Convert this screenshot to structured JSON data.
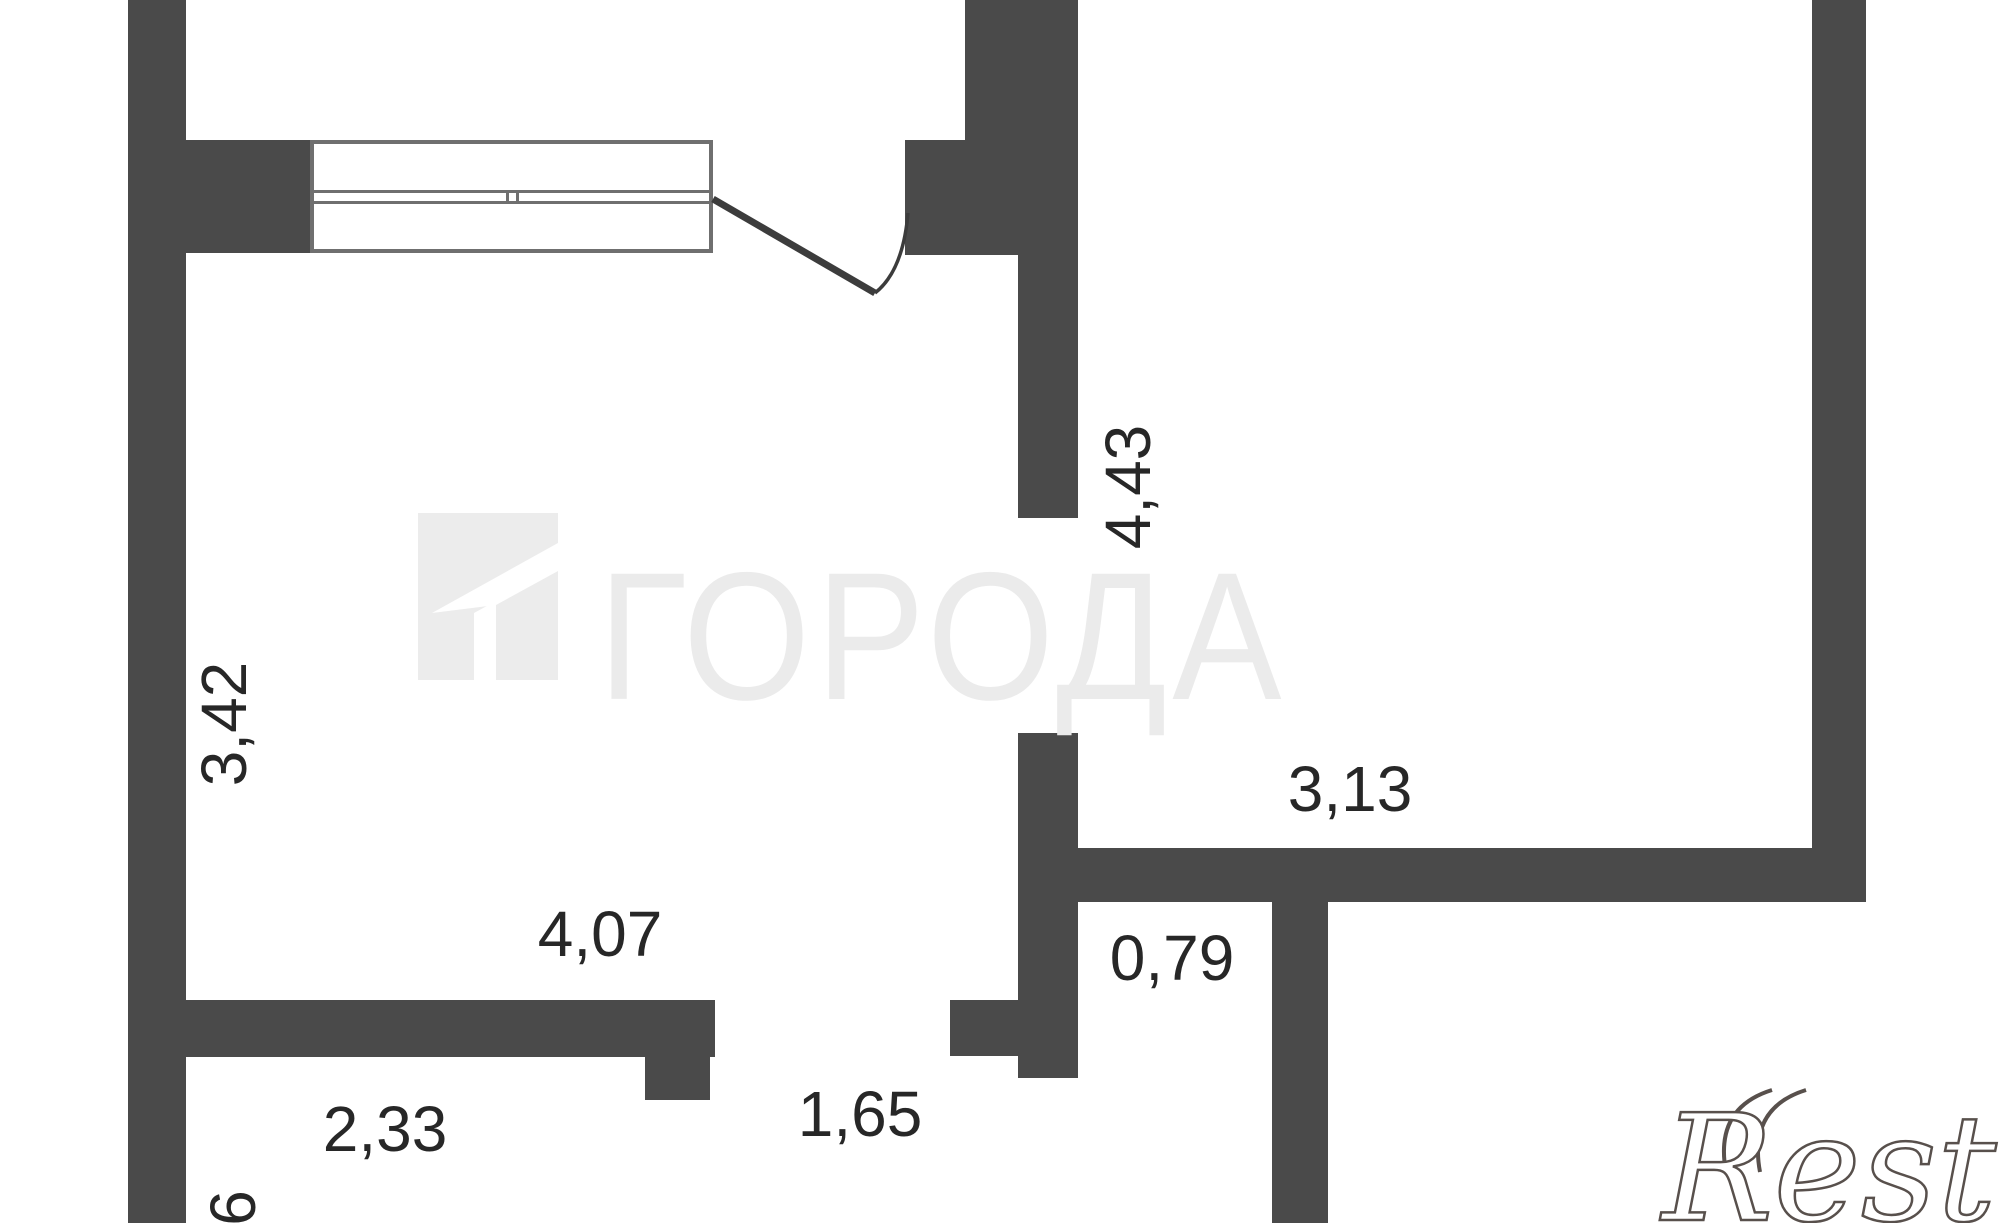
{
  "plan": {
    "background": "#ffffff",
    "wall_color": "#4a4a4a",
    "line_color": "#3c3c3c",
    "dimension_text_color": "#272727",
    "watermark_color": "#ebebeb",
    "dimensions": {
      "v_443": {
        "text": "4,43",
        "orientation": "vertical"
      },
      "v_342": {
        "text": "3,42",
        "orientation": "vertical"
      },
      "h_313": {
        "text": "3,13",
        "orientation": "horizontal"
      },
      "h_407": {
        "text": "4,07",
        "orientation": "horizontal"
      },
      "h_079": {
        "text": "0,79",
        "orientation": "horizontal"
      },
      "h_165": {
        "text": "1,65",
        "orientation": "horizontal"
      },
      "h_233": {
        "text": "2,33",
        "orientation": "horizontal"
      },
      "v_6": {
        "text": "6",
        "orientation": "vertical"
      }
    },
    "watermarks": {
      "center_logo_text": "ГОРОДА",
      "corner_logo_text": "Restate"
    }
  }
}
